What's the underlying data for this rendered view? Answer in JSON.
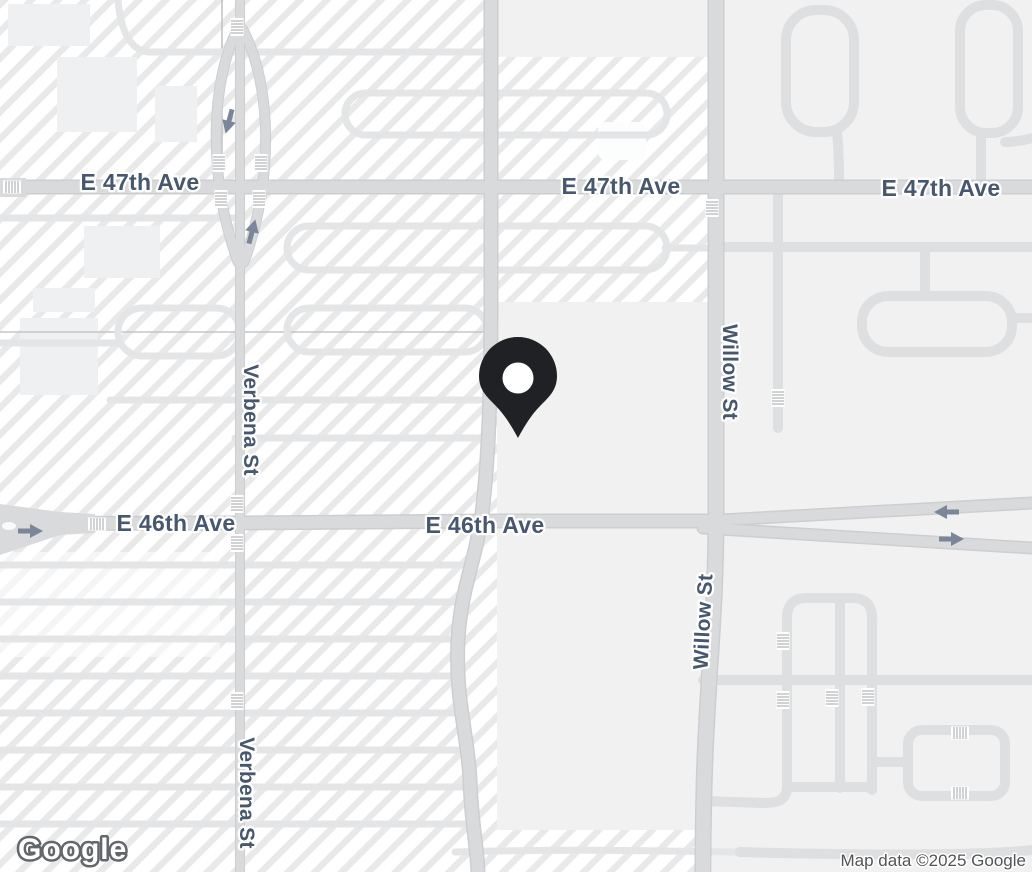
{
  "app": {
    "type": "map-static-view"
  },
  "streets": {
    "e47": {
      "label": "E 47th Ave"
    },
    "e46": {
      "label": "E 46th Ave"
    },
    "verbena": {
      "label": "Verbena St"
    },
    "willow": {
      "label": "Willow St"
    }
  },
  "marker": {
    "kind": "location-pin",
    "color": "#202124"
  },
  "attribution": {
    "logo": "Google",
    "text": "Map data ©2025 Google"
  },
  "colors": {
    "road_major": "#d9dadc",
    "road_minor": "#e4e5e7",
    "street_label": "#47586e",
    "hatch_stripe": "#e9e9ea",
    "flat_area": "#f1f1f2",
    "arrow": "#7b8798",
    "pin": "#202124"
  }
}
